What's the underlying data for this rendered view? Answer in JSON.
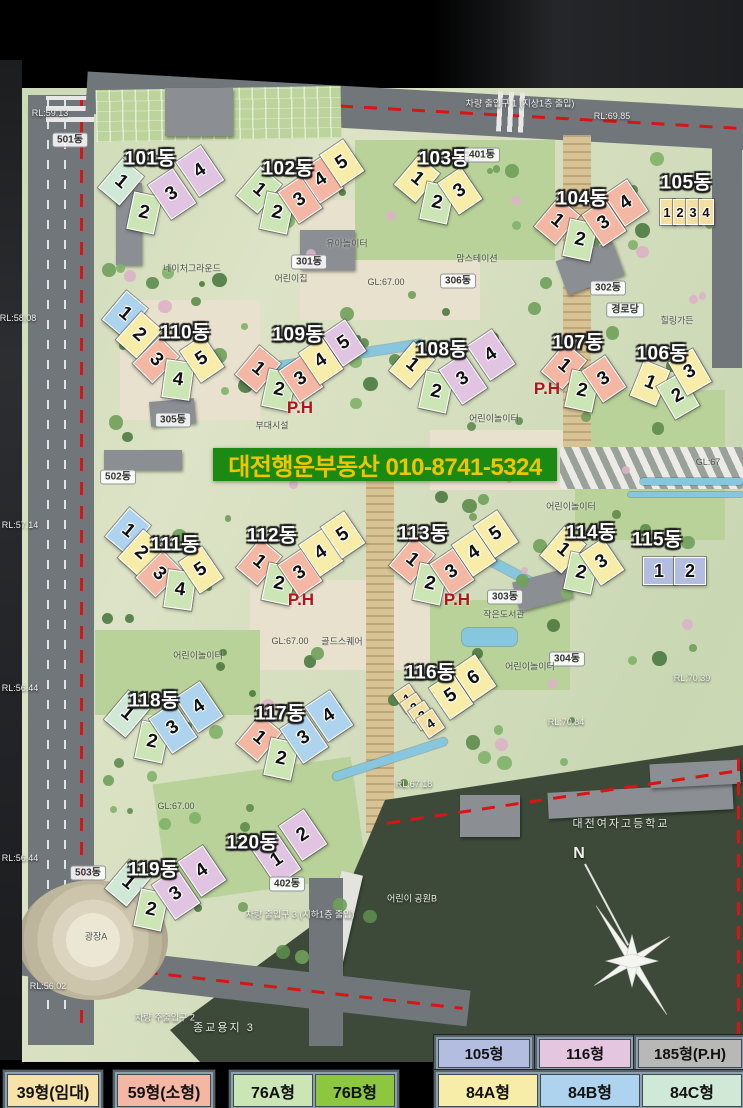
{
  "banner": {
    "text": "대전행운부동산 010-8741-5324"
  },
  "compass": {
    "label": "N"
  },
  "ph_label": "P.H",
  "ph": [
    {
      "x": 300,
      "y": 408
    },
    {
      "x": 547,
      "y": 389
    },
    {
      "x": 301,
      "y": 600
    },
    {
      "x": 457,
      "y": 600
    }
  ],
  "unit_colors": {
    "39": "#f5dfa0",
    "59": "#f3b7a3",
    "76A": "#cbe5b4",
    "76B": "#8dc63f",
    "84A": "#f7eda9",
    "84B": "#aed3ee",
    "84C": "#cfe9d6",
    "105": "#b3bddf",
    "116": "#e0c4e2",
    "185": "#b8b8b6"
  },
  "buildings": [
    {
      "name": "101동",
      "lx": 150,
      "ly": 157,
      "units": [
        {
          "n": "1",
          "x": 120,
          "y": 181,
          "c": "84C",
          "r": 40
        },
        {
          "n": "2",
          "x": 143,
          "y": 212,
          "c": "76A",
          "r": 12
        },
        {
          "n": "3",
          "x": 171,
          "y": 193,
          "c": "116",
          "r": -34,
          "w": 28,
          "h": 40
        },
        {
          "n": "4",
          "x": 199,
          "y": 170,
          "c": "116",
          "r": -34,
          "w": 28,
          "h": 40
        }
      ]
    },
    {
      "name": "102동",
      "lx": 288,
      "ly": 167,
      "units": [
        {
          "n": "1",
          "x": 258,
          "y": 189,
          "c": "76A",
          "r": 40
        },
        {
          "n": "2",
          "x": 276,
          "y": 212,
          "c": "76A",
          "r": 12
        },
        {
          "n": "3",
          "x": 299,
          "y": 199,
          "c": "59",
          "r": -34
        },
        {
          "n": "4",
          "x": 320,
          "y": 179,
          "c": "59",
          "r": -34
        },
        {
          "n": "5",
          "x": 341,
          "y": 162,
          "c": "84A",
          "r": -34
        }
      ]
    },
    {
      "name": "103동",
      "lx": 444,
      "ly": 157,
      "units": [
        {
          "n": "1",
          "x": 416,
          "y": 178,
          "c": "84A",
          "r": 40
        },
        {
          "n": "2",
          "x": 436,
          "y": 202,
          "c": "76A",
          "r": 12
        },
        {
          "n": "3",
          "x": 459,
          "y": 190,
          "c": "84A",
          "r": -34
        }
      ]
    },
    {
      "name": "104동",
      "lx": 582,
      "ly": 197,
      "units": [
        {
          "n": "1",
          "x": 556,
          "y": 220,
          "c": "59",
          "r": 40
        },
        {
          "n": "2",
          "x": 579,
          "y": 239,
          "c": "76A",
          "r": 12
        },
        {
          "n": "3",
          "x": 603,
          "y": 222,
          "c": "59",
          "r": -34
        },
        {
          "n": "4",
          "x": 625,
          "y": 202,
          "c": "59",
          "r": -34
        }
      ]
    },
    {
      "name": "105동",
      "lx": 686,
      "ly": 181,
      "units": [
        {
          "n": "1",
          "x": 666,
          "y": 211,
          "c": "39",
          "r": 0,
          "w": 13,
          "h": 24
        },
        {
          "n": "2",
          "x": 679,
          "y": 211,
          "c": "39",
          "r": 0,
          "w": 13,
          "h": 24
        },
        {
          "n": "3",
          "x": 692,
          "y": 211,
          "c": "39",
          "r": 0,
          "w": 13,
          "h": 24
        },
        {
          "n": "4",
          "x": 705,
          "y": 211,
          "c": "39",
          "r": 0,
          "w": 13,
          "h": 24
        }
      ]
    },
    {
      "name": "106동",
      "lx": 662,
      "ly": 352,
      "units": [
        {
          "n": "1",
          "x": 649,
          "y": 382,
          "c": "84A",
          "r": 22
        },
        {
          "n": "2",
          "x": 677,
          "y": 395,
          "c": "76A",
          "r": -30
        },
        {
          "n": "3",
          "x": 689,
          "y": 371,
          "c": "84A",
          "r": -30
        }
      ]
    },
    {
      "name": "107동",
      "lx": 578,
      "ly": 341,
      "units": [
        {
          "n": "1",
          "x": 563,
          "y": 365,
          "c": "59",
          "r": 40
        },
        {
          "n": "2",
          "x": 581,
          "y": 390,
          "c": "76A",
          "r": 12
        },
        {
          "n": "3",
          "x": 603,
          "y": 378,
          "c": "59",
          "r": -34
        }
      ]
    },
    {
      "name": "108동",
      "lx": 442,
      "ly": 348,
      "units": [
        {
          "n": "1",
          "x": 411,
          "y": 364,
          "c": "84A",
          "r": 40
        },
        {
          "n": "2",
          "x": 435,
          "y": 391,
          "c": "76A",
          "r": 12
        },
        {
          "n": "3",
          "x": 462,
          "y": 378,
          "c": "116",
          "r": -34,
          "w": 28,
          "h": 40
        },
        {
          "n": "4",
          "x": 490,
          "y": 354,
          "c": "116",
          "r": -34,
          "w": 28,
          "h": 40
        }
      ]
    },
    {
      "name": "109동",
      "lx": 298,
      "ly": 333,
      "units": [
        {
          "n": "1",
          "x": 257,
          "y": 368,
          "c": "59",
          "r": 40
        },
        {
          "n": "2",
          "x": 278,
          "y": 389,
          "c": "76A",
          "r": 12
        },
        {
          "n": "3",
          "x": 300,
          "y": 378,
          "c": "59",
          "r": -34
        },
        {
          "n": "4",
          "x": 320,
          "y": 360,
          "c": "84A",
          "r": -34
        },
        {
          "n": "5",
          "x": 343,
          "y": 342,
          "c": "116",
          "r": -34
        }
      ]
    },
    {
      "name": "110동",
      "lx": 185,
      "ly": 331,
      "units": [
        {
          "n": "1",
          "x": 124,
          "y": 313,
          "c": "84B",
          "r": 40
        },
        {
          "n": "2",
          "x": 138,
          "y": 334,
          "c": "84A",
          "r": 42
        },
        {
          "n": "3",
          "x": 155,
          "y": 359,
          "c": "59",
          "r": 45
        },
        {
          "n": "4",
          "x": 177,
          "y": 379,
          "c": "76A",
          "r": 8
        },
        {
          "n": "5",
          "x": 201,
          "y": 358,
          "c": "84A",
          "r": -34
        }
      ]
    },
    {
      "name": "111동",
      "lx": 175,
      "ly": 543,
      "units": [
        {
          "n": "1",
          "x": 127,
          "y": 530,
          "c": "84B",
          "r": 40
        },
        {
          "n": "2",
          "x": 140,
          "y": 552,
          "c": "84A",
          "r": 42
        },
        {
          "n": "3",
          "x": 158,
          "y": 573,
          "c": "59",
          "r": 45
        },
        {
          "n": "4",
          "x": 179,
          "y": 589,
          "c": "76A",
          "r": 8
        },
        {
          "n": "5",
          "x": 200,
          "y": 569,
          "c": "84A",
          "r": -34
        }
      ]
    },
    {
      "name": "112동",
      "lx": 272,
      "ly": 534,
      "units": [
        {
          "n": "1",
          "x": 258,
          "y": 561,
          "c": "59",
          "r": 40
        },
        {
          "n": "2",
          "x": 278,
          "y": 583,
          "c": "76A",
          "r": 12
        },
        {
          "n": "3",
          "x": 299,
          "y": 572,
          "c": "59",
          "r": -34
        },
        {
          "n": "4",
          "x": 320,
          "y": 552,
          "c": "84A",
          "r": -34
        },
        {
          "n": "5",
          "x": 342,
          "y": 534,
          "c": "84A",
          "r": -34
        }
      ]
    },
    {
      "name": "113동",
      "lx": 423,
      "ly": 532,
      "units": [
        {
          "n": "1",
          "x": 411,
          "y": 559,
          "c": "59",
          "r": 40
        },
        {
          "n": "2",
          "x": 429,
          "y": 583,
          "c": "76A",
          "r": 12
        },
        {
          "n": "3",
          "x": 451,
          "y": 571,
          "c": "59",
          "r": -34
        },
        {
          "n": "4",
          "x": 473,
          "y": 552,
          "c": "84A",
          "r": -34
        },
        {
          "n": "5",
          "x": 495,
          "y": 533,
          "c": "84A",
          "r": -34
        }
      ]
    },
    {
      "name": "114동",
      "lx": 591,
      "ly": 531,
      "units": [
        {
          "n": "1",
          "x": 562,
          "y": 549,
          "c": "84A",
          "r": 40
        },
        {
          "n": "2",
          "x": 580,
          "y": 572,
          "c": "76A",
          "r": 12
        },
        {
          "n": "3",
          "x": 601,
          "y": 561,
          "c": "84A",
          "r": -34
        }
      ]
    },
    {
      "name": "115동",
      "lx": 657,
      "ly": 538,
      "units": [
        {
          "n": "1",
          "x": 658,
          "y": 570,
          "c": "105",
          "r": 0,
          "w": 30,
          "h": 26
        },
        {
          "n": "2",
          "x": 689,
          "y": 570,
          "c": "105",
          "r": 0,
          "w": 30,
          "h": 26
        }
      ]
    },
    {
      "name": "116동",
      "lx": 430,
      "ly": 671,
      "units": [
        {
          "n": "1",
          "x": 406,
          "y": 697,
          "c": "39",
          "r": -34,
          "w": 17,
          "h": 21
        },
        {
          "n": "2",
          "x": 413,
          "y": 706,
          "c": "39",
          "r": -34,
          "w": 17,
          "h": 21
        },
        {
          "n": "3",
          "x": 421,
          "y": 714,
          "c": "39",
          "r": -34,
          "w": 17,
          "h": 21
        },
        {
          "n": "4",
          "x": 429,
          "y": 722,
          "c": "39",
          "r": -34,
          "w": 17,
          "h": 21
        },
        {
          "n": "5",
          "x": 450,
          "y": 695,
          "c": "84A",
          "r": -34
        },
        {
          "n": "6",
          "x": 473,
          "y": 677,
          "c": "84A",
          "r": -34
        }
      ]
    },
    {
      "name": "117동",
      "lx": 280,
      "ly": 712,
      "units": [
        {
          "n": "1",
          "x": 258,
          "y": 737,
          "c": "59",
          "r": 40
        },
        {
          "n": "2",
          "x": 280,
          "y": 758,
          "c": "76A",
          "r": 12
        },
        {
          "n": "3",
          "x": 303,
          "y": 737,
          "c": "84B",
          "r": -34,
          "w": 28,
          "h": 40
        },
        {
          "n": "4",
          "x": 328,
          "y": 715,
          "c": "84B",
          "r": -34,
          "w": 28,
          "h": 40
        }
      ]
    },
    {
      "name": "118동",
      "lx": 154,
      "ly": 699,
      "units": [
        {
          "n": "1",
          "x": 126,
          "y": 713,
          "c": "84C",
          "r": 40
        },
        {
          "n": "2",
          "x": 151,
          "y": 741,
          "c": "76A",
          "r": 12
        },
        {
          "n": "3",
          "x": 172,
          "y": 727,
          "c": "84B",
          "r": -34,
          "w": 28,
          "h": 40
        },
        {
          "n": "4",
          "x": 198,
          "y": 706,
          "c": "84B",
          "r": -34,
          "w": 28,
          "h": 40
        }
      ]
    },
    {
      "name": "119동",
      "lx": 153,
      "ly": 868,
      "units": [
        {
          "n": "1",
          "x": 127,
          "y": 882,
          "c": "84C",
          "r": 40
        },
        {
          "n": "2",
          "x": 150,
          "y": 909,
          "c": "76A",
          "r": 12
        },
        {
          "n": "3",
          "x": 175,
          "y": 893,
          "c": "116",
          "r": -34,
          "w": 28,
          "h": 40
        },
        {
          "n": "4",
          "x": 201,
          "y": 870,
          "c": "116",
          "r": -34,
          "w": 28,
          "h": 40
        }
      ]
    },
    {
      "name": "120동",
      "lx": 252,
      "ly": 841,
      "units": [
        {
          "n": "1",
          "x": 276,
          "y": 859,
          "c": "116",
          "r": -34,
          "w": 28,
          "h": 40
        },
        {
          "n": "2",
          "x": 302,
          "y": 834,
          "c": "116",
          "r": -34,
          "w": 28,
          "h": 40
        }
      ]
    }
  ],
  "map_labels": [
    {
      "t": "501동",
      "x": 70,
      "y": 140,
      "k": "b"
    },
    {
      "t": "502동",
      "x": 118,
      "y": 477,
      "k": "b"
    },
    {
      "t": "503동",
      "x": 88,
      "y": 873,
      "k": "b"
    },
    {
      "t": "301동",
      "x": 309,
      "y": 262,
      "k": "b"
    },
    {
      "t": "302동",
      "x": 608,
      "y": 288,
      "k": "b"
    },
    {
      "t": "303동",
      "x": 505,
      "y": 597,
      "k": "b"
    },
    {
      "t": "304동",
      "x": 567,
      "y": 659,
      "k": "b"
    },
    {
      "t": "305동",
      "x": 173,
      "y": 420,
      "k": "b"
    },
    {
      "t": "306동",
      "x": 458,
      "y": 281,
      "k": "b"
    },
    {
      "t": "401동",
      "x": 482,
      "y": 155,
      "k": "b"
    },
    {
      "t": "402동",
      "x": 287,
      "y": 884,
      "k": "b"
    },
    {
      "t": "경로당",
      "x": 625,
      "y": 310,
      "k": "b"
    },
    {
      "t": "어린이집",
      "x": 291,
      "y": 278,
      "k": "s"
    },
    {
      "t": "유아놀이터",
      "x": 347,
      "y": 243,
      "k": "s"
    },
    {
      "t": "네이처그라운드",
      "x": 192,
      "y": 268,
      "k": "s"
    },
    {
      "t": "맘스테이션",
      "x": 477,
      "y": 258,
      "k": "s"
    },
    {
      "t": "힐링가든",
      "x": 677,
      "y": 320,
      "k": "s"
    },
    {
      "t": "어린이놀이터",
      "x": 494,
      "y": 418,
      "k": "s"
    },
    {
      "t": "어린이놀이터",
      "x": 571,
      "y": 506,
      "k": "s"
    },
    {
      "t": "어린이놀이터",
      "x": 198,
      "y": 655,
      "k": "s"
    },
    {
      "t": "어린이놀이터",
      "x": 530,
      "y": 666,
      "k": "s"
    },
    {
      "t": "작은도서관",
      "x": 504,
      "y": 614,
      "k": "s"
    },
    {
      "t": "골드스퀘어",
      "x": 342,
      "y": 641,
      "k": "s"
    },
    {
      "t": "부대시설",
      "x": 272,
      "y": 425,
      "k": "s"
    },
    {
      "t": "광장A",
      "x": 96,
      "y": 936,
      "k": "s"
    },
    {
      "t": "GL:67.00",
      "x": 386,
      "y": 282,
      "k": "s"
    },
    {
      "t": "GL:67.00",
      "x": 290,
      "y": 641,
      "k": "s"
    },
    {
      "t": "GL:67.00",
      "x": 176,
      "y": 806,
      "k": "s"
    },
    {
      "t": "GL:67",
      "x": 708,
      "y": 462,
      "k": "s"
    },
    {
      "t": "RL:59.13",
      "x": 50,
      "y": 113,
      "k": "w"
    },
    {
      "t": "RL:69.85",
      "x": 612,
      "y": 116,
      "k": "w"
    },
    {
      "t": "RL:58.08",
      "x": 18,
      "y": 318,
      "k": "w"
    },
    {
      "t": "RL:57.14",
      "x": 20,
      "y": 525,
      "k": "w"
    },
    {
      "t": "RL:56.44",
      "x": 20,
      "y": 688,
      "k": "w"
    },
    {
      "t": "RL:56.44",
      "x": 20,
      "y": 858,
      "k": "w"
    },
    {
      "t": "RL:70.39",
      "x": 692,
      "y": 678,
      "k": "w"
    },
    {
      "t": "RL:70.84",
      "x": 566,
      "y": 722,
      "k": "w"
    },
    {
      "t": "RL:67.18",
      "x": 414,
      "y": 784,
      "k": "w"
    },
    {
      "t": "RL:56.02",
      "x": 48,
      "y": 986,
      "k": "w"
    },
    {
      "t": "차량 출입구 1 (지상1층 출입)",
      "x": 520,
      "y": 103,
      "k": "w"
    },
    {
      "t": "차량 출입구 3 (지하1층 출입)",
      "x": 300,
      "y": 914,
      "k": "w"
    },
    {
      "t": "차량 주출입구 2",
      "x": 165,
      "y": 1017,
      "k": "w"
    },
    {
      "t": "어린이 공원B",
      "x": 412,
      "y": 898,
      "k": "w"
    },
    {
      "t": "대전여자고등학교",
      "x": 621,
      "y": 823,
      "k": "W"
    },
    {
      "t": "종교용지 3",
      "x": 224,
      "y": 1027,
      "k": "W"
    }
  ],
  "legend": {
    "rows": [
      {
        "y": 1035,
        "h": 27,
        "fs": 15,
        "groups": [
          {
            "x": 434,
            "cells": [
              {
                "label": "105형",
                "color": "#b3bddf",
                "w": 90
              }
            ]
          },
          {
            "x": 535,
            "cells": [
              {
                "label": "116형",
                "color": "#e4c6e0",
                "w": 90
              }
            ]
          },
          {
            "x": 634,
            "cells": [
              {
                "label": "185형(P.H)",
                "color": "#b8b8b6",
                "w": 102
              }
            ]
          }
        ]
      },
      {
        "y": 1070,
        "h": 31,
        "fs": 16,
        "groups": [
          {
            "x": 3,
            "cells": [
              {
                "label": "39형(임대)",
                "color": "#f7e3a8",
                "w": 90
              }
            ]
          },
          {
            "x": 113,
            "cells": [
              {
                "label": "59형(소형)",
                "color": "#f3b7a3",
                "w": 92
              }
            ]
          },
          {
            "x": 229,
            "cells": [
              {
                "label": "76A형",
                "color": "#cbe5b4",
                "w": 78
              },
              {
                "label": "76B형",
                "color": "#8dc63f",
                "w": 78
              }
            ]
          },
          {
            "x": 434,
            "cells": [
              {
                "label": "84A형",
                "color": "#f7eda9",
                "w": 98
              },
              {
                "label": "84B형",
                "color": "#aed3ee",
                "w": 98
              },
              {
                "label": "84C형",
                "color": "#cfe9d6",
                "w": 98
              }
            ]
          }
        ]
      }
    ]
  }
}
